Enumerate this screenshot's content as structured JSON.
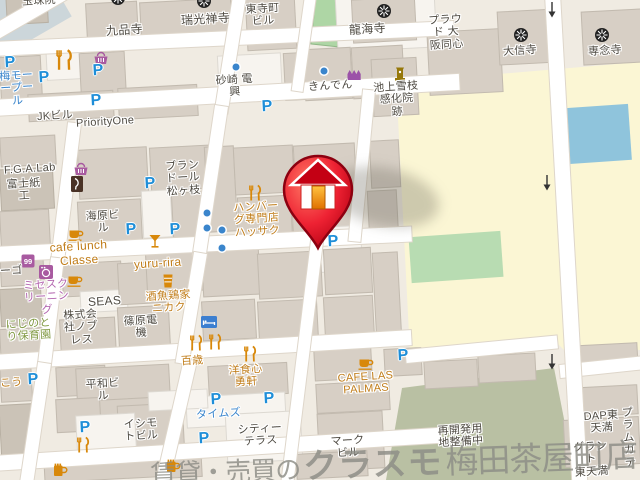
{
  "colors": {
    "parking": "#1e8ed8",
    "poi_orange": "#d8880a",
    "poi_purple": "#a85aa0",
    "label_dark": "#4e4a42",
    "label_orange": "#c07c18",
    "label_blue": "#3a85cc",
    "label_purple": "#b264ae",
    "label_green": "#7f9840",
    "road_main_yellow": "#fbf6d4",
    "park_green": "#b8dcb2",
    "water_blue": "#8fc4dc",
    "redevelopment_green": "#b9c0a3",
    "temple_ground_blue": "#ccd6da",
    "marker_red": "#d40016"
  },
  "watermark": {
    "prefix": "賃貸・売買の",
    "logo": "クラスモ",
    "suffix": "梅田茶屋町店"
  },
  "map": {
    "parking_letter": "P",
    "labels": [
      {
        "name": "gyokushuin",
        "text": "玉珠院",
        "color": "dark",
        "x": 22,
        "y": -5,
        "fs": 11
      },
      {
        "name": "kuhonji",
        "text": "九品寺",
        "color": "dark",
        "x": 106,
        "y": 24,
        "fs": 12
      },
      {
        "name": "zuiko-zenji",
        "text": "瑞光禅寺",
        "color": "dark",
        "x": 181,
        "y": 13,
        "fs": 12
      },
      {
        "name": "tojicho-bldg",
        "text": "東寺町\nビル",
        "color": "dark",
        "x": 246,
        "y": 3,
        "fs": 11
      },
      {
        "name": "ryukaiji",
        "text": "龍海寺",
        "color": "dark",
        "x": 349,
        "y": 23,
        "fs": 12
      },
      {
        "name": "proud-osaka-doshin",
        "text": "プラウ\nド 大\n阪同心",
        "color": "dark",
        "x": 429,
        "y": 14,
        "fs": 11
      },
      {
        "name": "daishinji",
        "text": "大信寺",
        "color": "dark",
        "x": 503,
        "y": 45,
        "fs": 11
      },
      {
        "name": "sennenji",
        "text": "専念寺",
        "color": "dark",
        "x": 588,
        "y": 45,
        "fs": 11
      },
      {
        "name": "ume-motor-pool",
        "text": "梅モー\nープー\nル",
        "color": "blue",
        "x": 0,
        "y": 70,
        "fs": 11
      },
      {
        "name": "jk-bldg",
        "text": "JKビル",
        "color": "dark",
        "x": 37,
        "y": 110,
        "fs": 11
      },
      {
        "name": "priority-one",
        "text": "PriorityOne",
        "color": "dark",
        "x": 76,
        "y": 116,
        "fs": 11
      },
      {
        "name": "sunazaki-denko",
        "text": "砂崎 電\n興",
        "color": "dark",
        "x": 216,
        "y": 74,
        "fs": 11
      },
      {
        "name": "kinden",
        "text": "きんでん",
        "color": "dark",
        "x": 308,
        "y": 80,
        "fs": 11
      },
      {
        "name": "ikegami-yukie-site",
        "text": "池上雪枝\n感化院\n跡",
        "color": "dark",
        "x": 374,
        "y": 81,
        "fs": 11
      },
      {
        "name": "fga-lab",
        "text": "F.G.A.Lab",
        "color": "dark",
        "x": 4,
        "y": 163,
        "fs": 11
      },
      {
        "name": "fujishiko",
        "text": "富士紙\n工",
        "color": "dark",
        "x": 7,
        "y": 178,
        "fs": 11
      },
      {
        "name": "brandol-matsugae",
        "text": "ブラン\nドール\n松ヶ枝",
        "color": "dark",
        "x": 166,
        "y": 160,
        "fs": 11
      },
      {
        "name": "kaihara-bldg",
        "text": "海原ビ\nル",
        "color": "dark",
        "x": 86,
        "y": 210,
        "fs": 11
      },
      {
        "name": "hamburg-hassaku",
        "text": "ハンバー\nグ専門店\nハッサク",
        "color": "orange",
        "x": 234,
        "y": 201,
        "fs": 11
      },
      {
        "name": "cafe-lunch-classe",
        "text": "cafe lunch\nClasse",
        "color": "orange",
        "x": 50,
        "y": 240,
        "fs": 12
      },
      {
        "name": "yuru-rira",
        "text": "yuru-rira",
        "color": "orange",
        "x": 134,
        "y": 257,
        "fs": 12
      },
      {
        "name": "mrs-cleaning",
        "text": "ミセスク\nリーニン\nグ",
        "color": "purple",
        "x": 24,
        "y": 279,
        "fs": 11
      },
      {
        "name": "nijinotori-hoikuen",
        "text": "にじのと\nり保育園",
        "color": "green",
        "x": 6,
        "y": 318,
        "fs": 11
      },
      {
        "name": "seas",
        "text": "SEAS",
        "color": "dark",
        "x": 88,
        "y": 295,
        "fs": 12
      },
      {
        "name": "noblesse",
        "text": "株式会\n社ノブ\nレス",
        "color": "dark",
        "x": 64,
        "y": 309,
        "fs": 11
      },
      {
        "name": "shinohara-denki",
        "text": "篠原電\n機",
        "color": "dark",
        "x": 124,
        "y": 315,
        "fs": 11
      },
      {
        "name": "nikaku",
        "text": "酒魚鶏家\nニカク",
        "color": "orange",
        "x": 146,
        "y": 290,
        "fs": 11
      },
      {
        "name": "hyakusai",
        "text": "百歳",
        "color": "orange",
        "x": 181,
        "y": 355,
        "fs": 11
      },
      {
        "name": "heiwa-bldg",
        "text": "平和ビ\nル",
        "color": "dark",
        "x": 86,
        "y": 378,
        "fs": 11
      },
      {
        "name": "ishimoto-bldg",
        "text": "イシモ\nトビル",
        "color": "dark",
        "x": 124,
        "y": 418,
        "fs": 11
      },
      {
        "name": "times",
        "text": "タイムズ",
        "color": "blue",
        "x": 196,
        "y": 408,
        "fs": 11
      },
      {
        "name": "yoshoku-shin-yuken",
        "text": "洋食心\n勇軒",
        "color": "orange",
        "x": 229,
        "y": 364,
        "fs": 11
      },
      {
        "name": "city-terrace",
        "text": "シティー\nテラス",
        "color": "dark",
        "x": 238,
        "y": 423,
        "fs": 11
      },
      {
        "name": "cafe-las-palmas",
        "text": "CAFE LAS\nPALMAS",
        "color": "orange",
        "x": 338,
        "y": 371,
        "fs": 11
      },
      {
        "name": "mark-bldg",
        "text": "マーク\nビル",
        "color": "dark",
        "x": 331,
        "y": 435,
        "fs": 11
      },
      {
        "name": "redevelopment-note",
        "text": "再開発用\n地整備中",
        "color": "dark",
        "x": 438,
        "y": 424,
        "fs": 11
      },
      {
        "name": "dap-higashitemma",
        "text": "DAP東\n天満",
        "color": "dark",
        "x": 584,
        "y": 410,
        "fs": 11
      },
      {
        "name": "plum-garden",
        "text": "プラ\nムガ\nテ",
        "color": "dark",
        "x": 618,
        "y": 407,
        "fs": 11
      },
      {
        "name": "grand-bldg",
        "text": "グラン\nト\n東天満",
        "color": "dark",
        "x": 574,
        "y": 441,
        "fs": 11
      },
      {
        "name": "partial-go",
        "text": "ーゴ",
        "color": "dark",
        "x": 0,
        "y": 265,
        "fs": 11
      },
      {
        "name": "partial-kou",
        "text": "こう",
        "color": "orange",
        "x": 0,
        "y": 377,
        "fs": 11
      }
    ],
    "parking_markers": [
      {
        "x": 10,
        "y": 63
      },
      {
        "x": 44,
        "y": 78
      },
      {
        "x": 98,
        "y": 71
      },
      {
        "x": 96,
        "y": 101
      },
      {
        "x": 267,
        "y": 107
      },
      {
        "x": 150,
        "y": 184
      },
      {
        "x": 131,
        "y": 230
      },
      {
        "x": 175,
        "y": 230
      },
      {
        "x": 333,
        "y": 242
      },
      {
        "x": 33,
        "y": 380
      },
      {
        "x": 85,
        "y": 428
      },
      {
        "x": 216,
        "y": 400
      },
      {
        "x": 204,
        "y": 439
      },
      {
        "x": 269,
        "y": 399
      },
      {
        "x": 403,
        "y": 356
      }
    ],
    "poi_dots": [
      {
        "x": 236,
        "y": 67
      },
      {
        "x": 324,
        "y": 71
      },
      {
        "x": 207,
        "y": 213
      },
      {
        "x": 207,
        "y": 228
      },
      {
        "x": 222,
        "y": 230
      },
      {
        "x": 222,
        "y": 248
      }
    ],
    "icons": [
      {
        "type": "temple",
        "name": "temple-icon",
        "x": 118,
        "y": -2
      },
      {
        "type": "temple",
        "name": "temple-icon",
        "x": 204,
        "y": 1
      },
      {
        "type": "temple",
        "name": "temple-icon",
        "x": 384,
        "y": 11
      },
      {
        "type": "temple",
        "name": "temple-icon",
        "x": 521,
        "y": 35
      },
      {
        "type": "temple",
        "name": "temple-icon",
        "x": 602,
        "y": 35
      },
      {
        "type": "restaurant",
        "name": "restaurant-icon",
        "x": 64,
        "y": 60,
        "s": 1.3
      },
      {
        "type": "restaurant",
        "name": "restaurant-icon",
        "x": 255,
        "y": 193
      },
      {
        "type": "restaurant",
        "name": "restaurant-icon",
        "x": 196,
        "y": 343
      },
      {
        "type": "restaurant",
        "name": "restaurant-icon",
        "x": 215,
        "y": 342
      },
      {
        "type": "restaurant",
        "name": "restaurant-icon",
        "x": 250,
        "y": 354
      },
      {
        "type": "restaurant",
        "name": "restaurant-icon",
        "x": 83,
        "y": 445
      },
      {
        "type": "basket",
        "name": "shopping-basket-icon",
        "x": 101,
        "y": 58
      },
      {
        "type": "basket",
        "name": "shopping-basket-icon",
        "x": 81,
        "y": 169
      },
      {
        "type": "knife",
        "name": "knife-shop-icon",
        "x": 77,
        "y": 184
      },
      {
        "type": "cup",
        "name": "cafe-cup-icon",
        "x": 76,
        "y": 234
      },
      {
        "type": "cup",
        "name": "cafe-cup-icon",
        "x": 75,
        "y": 280
      },
      {
        "type": "cup",
        "name": "cafe-cup-icon",
        "x": 366,
        "y": 363
      },
      {
        "type": "cocktail",
        "name": "cocktail-icon",
        "x": 155,
        "y": 241
      },
      {
        "type": "tumbler",
        "name": "drink-glass-icon",
        "x": 168,
        "y": 281
      },
      {
        "type": "laundry",
        "name": "laundry-machine-icon",
        "x": 46,
        "y": 272
      },
      {
        "type": "shop99",
        "name": "shop-99-icon",
        "x": 28,
        "y": 261
      },
      {
        "type": "factory",
        "name": "factory-icon",
        "x": 355,
        "y": 74
      },
      {
        "type": "monument",
        "name": "monument-icon",
        "x": 400,
        "y": 74
      },
      {
        "type": "bed",
        "name": "hotel-bed-icon",
        "x": 209,
        "y": 322
      },
      {
        "type": "mug",
        "name": "beer-mug-icon",
        "x": 60,
        "y": 470
      },
      {
        "type": "mug",
        "name": "beer-mug-icon",
        "x": 173,
        "y": 466
      }
    ],
    "oneway_arrows": [
      {
        "x": 552,
        "y": 10
      },
      {
        "x": 547,
        "y": 183
      },
      {
        "x": 552,
        "y": 362
      }
    ],
    "property_pin": {
      "x": 318,
      "y": 248,
      "kind": "red-house-pin"
    }
  }
}
